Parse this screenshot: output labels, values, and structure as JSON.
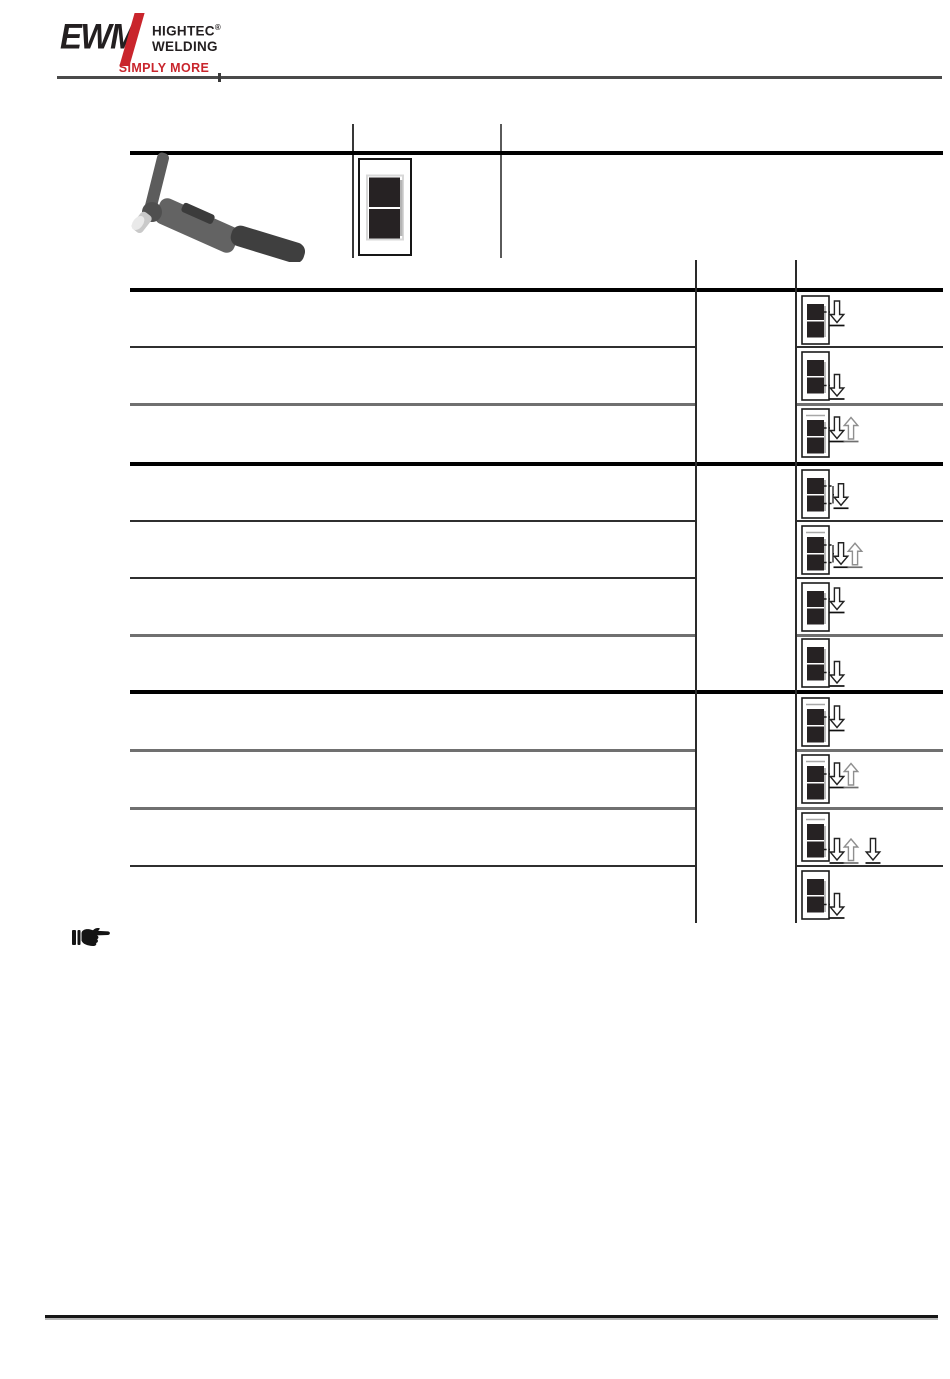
{
  "logo": {
    "brand": "EWM",
    "subbrand_top": "HIGHTEC",
    "subbrand_reg": "®",
    "subbrand_bottom": "WELDING",
    "tagline": "SIMPLY MORE"
  },
  "colors": {
    "brand_red": "#c9252c",
    "ink": "#231f20",
    "segment_dark": "#262223",
    "arrow_down_stroke": "#222222",
    "arrow_up_stroke": "#8f8f8f",
    "rule_gray": "#4a4a4a"
  },
  "table": {
    "header": {
      "image": "tig-welding-torch-photo",
      "display": {
        "type": "two-segment-display",
        "segments": 2
      }
    },
    "groups": [
      {
        "rows": [
          {
            "display_topline": false,
            "exit": "upper",
            "arrows": [
              "down"
            ]
          },
          {
            "display_topline": false,
            "exit": "lower",
            "arrows": [
              "down"
            ]
          },
          {
            "display_topline": true,
            "exit": "upper",
            "arrows": [
              "down",
              "up"
            ]
          }
        ]
      },
      {
        "rows": [
          {
            "display_topline": false,
            "exit": "both",
            "arrows": [
              "down"
            ]
          },
          {
            "display_topline": true,
            "exit": "both",
            "arrows": [
              "down",
              "up"
            ]
          },
          {
            "display_topline": false,
            "exit": "upper",
            "arrows": [
              "down"
            ]
          },
          {
            "display_topline": false,
            "exit": "lower",
            "arrows": [
              "down"
            ]
          }
        ]
      },
      {
        "rows": [
          {
            "display_topline": true,
            "exit": "upper",
            "arrows": [
              "down"
            ]
          },
          {
            "display_topline": true,
            "exit": "upper",
            "arrows": [
              "down",
              "up"
            ]
          },
          {
            "display_topline": true,
            "exit": "lower",
            "arrows": [
              "down",
              "up",
              "gap",
              "down"
            ]
          },
          {
            "display_topline": false,
            "exit": "lower",
            "arrows": [
              "down"
            ]
          }
        ]
      }
    ]
  },
  "note": {
    "icon": "pointing-hand"
  }
}
